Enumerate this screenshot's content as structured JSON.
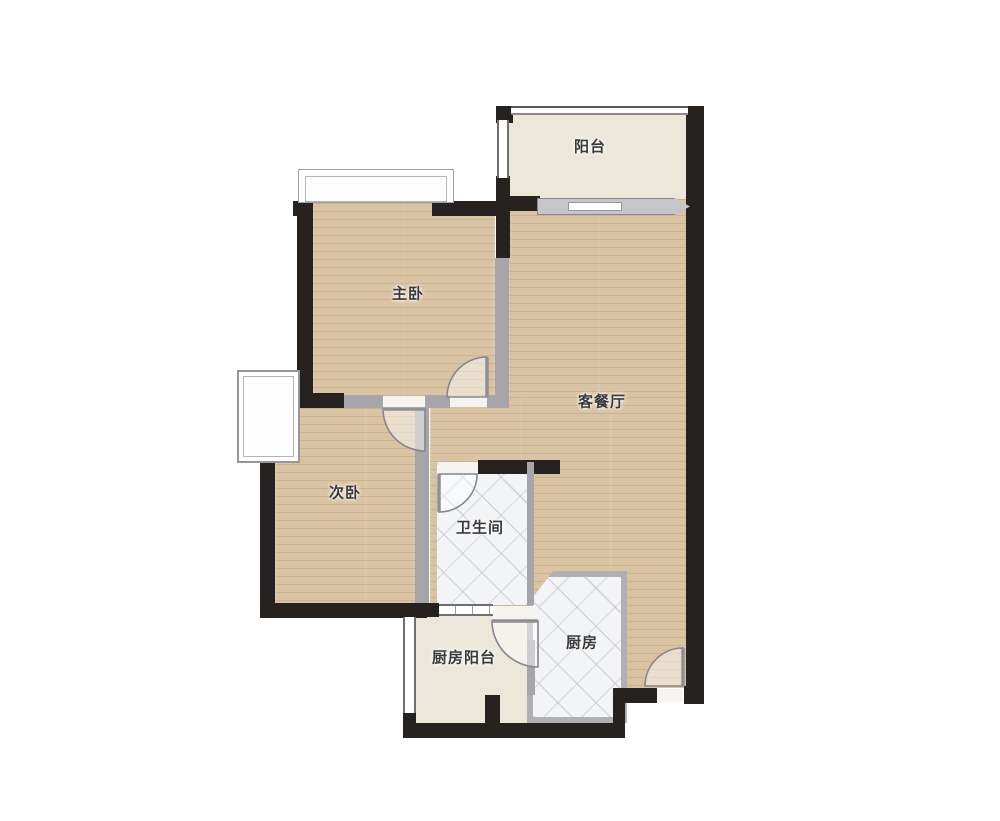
{
  "title": "户型图",
  "rooms": [
    {
      "id": "balcony",
      "label": "阳台"
    },
    {
      "id": "master-bedroom",
      "label": "主卧"
    },
    {
      "id": "living-dining",
      "label": "客餐厅"
    },
    {
      "id": "second-bedroom",
      "label": "次卧"
    },
    {
      "id": "bathroom",
      "label": "卫生间"
    },
    {
      "id": "kitchen-balcony",
      "label": "厨房阳台"
    },
    {
      "id": "kitchen",
      "label": "厨房"
    }
  ],
  "theme": {
    "colors": {
      "background": "#ffffff",
      "wall": "#262220",
      "partition": "#a6a6aa",
      "wood": "#d9c3a3",
      "tile": "#f3f4f6",
      "cream": "#ebe8d9",
      "slider": "#c6c6ca",
      "label": "#3a3a3a"
    }
  }
}
